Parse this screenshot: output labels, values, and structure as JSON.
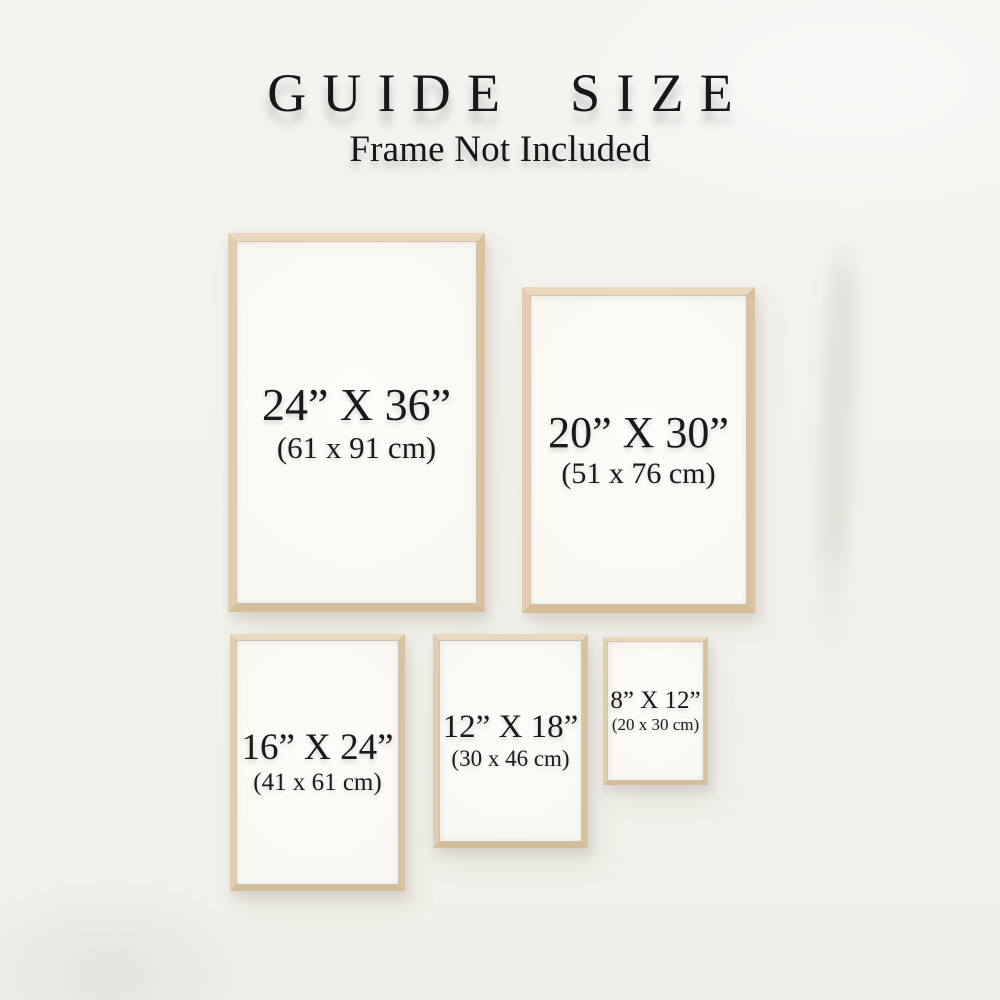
{
  "page": {
    "title": "GUIDE SIZE",
    "subtitle": "Frame Not Included"
  },
  "frames": [
    {
      "name": "24x36",
      "inches": "24” X 36”",
      "cm": "(61 x 91 cm)"
    },
    {
      "name": "20x30",
      "inches": "20” X 30”",
      "cm": "(51 x 76 cm)"
    },
    {
      "name": "16x24",
      "inches": "16” X 24”",
      "cm": "(41 x 61 cm)"
    },
    {
      "name": "12x18",
      "inches": "12” X 18”",
      "cm": "(30 x 46 cm)"
    },
    {
      "name": "8x12",
      "inches": "8” X 12”",
      "cm": "(20 x 30 cm)"
    }
  ],
  "colors": {
    "wall_background": "#f3f1ec",
    "frame_wood": "#ddc8a8",
    "paper_white": "#fbfaf6",
    "text": "#1b1a18"
  }
}
